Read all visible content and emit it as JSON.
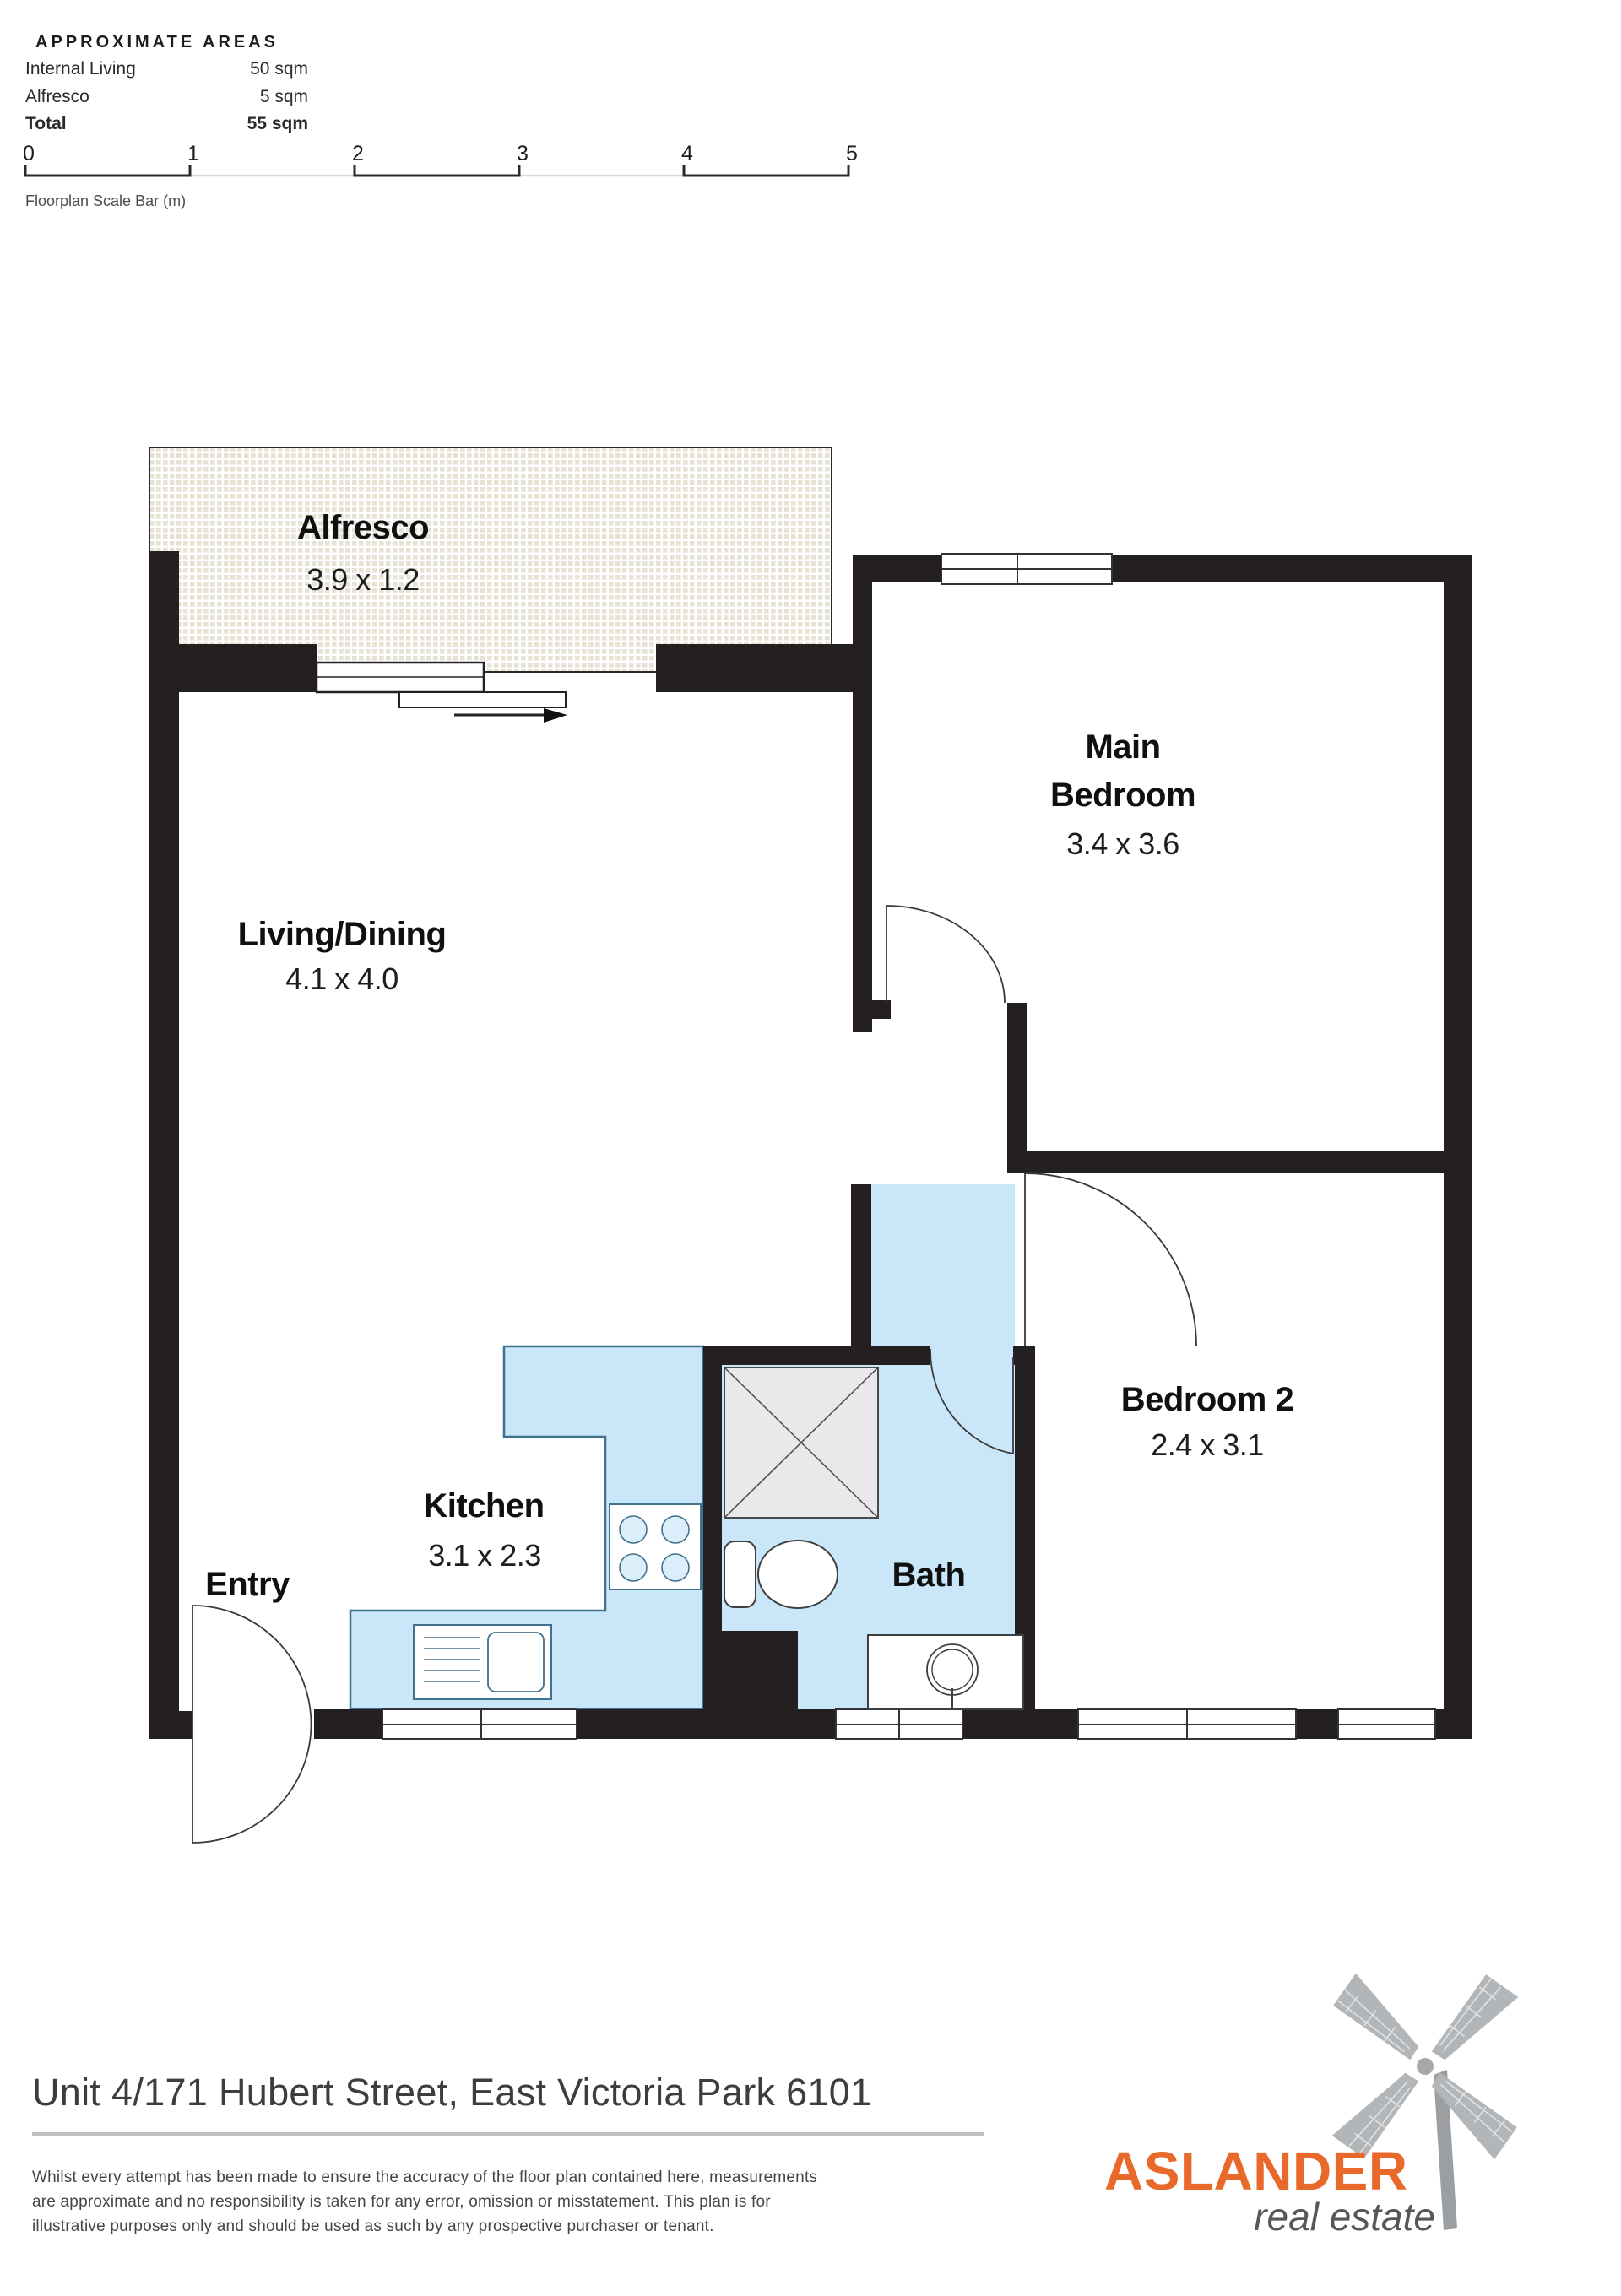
{
  "areas": {
    "title": "APPROXIMATE AREAS",
    "rows": [
      {
        "label": "Internal Living",
        "value": "50 sqm"
      },
      {
        "label": "Alfresco",
        "value": "5 sqm"
      },
      {
        "label": "Total",
        "value": "55 sqm"
      }
    ]
  },
  "scale_bar": {
    "ticks": [
      "0",
      "1",
      "2",
      "3",
      "4",
      "5"
    ],
    "caption": "Floorplan Scale Bar (m)"
  },
  "rooms": {
    "alfresco": {
      "name": "Alfresco",
      "dims": "3.9 x 1.2"
    },
    "living": {
      "name": "Living/Dining",
      "dims": "4.1 x 4.0"
    },
    "main_bedroom": {
      "name_line1": "Main",
      "name_line2": "Bedroom",
      "dims": "3.4 x 3.6"
    },
    "kitchen": {
      "name": "Kitchen",
      "dims": "3.1 x 2.3"
    },
    "bath": {
      "name": "Bath"
    },
    "bedroom2": {
      "name": "Bedroom 2",
      "dims": "2.4 x 3.1"
    },
    "entry": {
      "name": "Entry"
    }
  },
  "footer": {
    "address": "Unit 4/171 Hubert Street, East Victoria Park 6101",
    "disclaimer_lines": [
      "Whilst every attempt has been made to ensure the accuracy of the floor plan contained here, measurements",
      "are approximate and no responsibility is taken for any error, omission or misstatement. This plan is for",
      "illustrative purposes only and should be used as such by any prospective purchaser or tenant."
    ]
  },
  "brand": {
    "name": "ASLANDER",
    "tagline": "real estate"
  },
  "colors": {
    "wall": "#241f20",
    "wet_area": "#c9e7f8",
    "wet_stroke": "#41718c",
    "hatch": "#e6e3d5",
    "fixture_line": "#3f3f3f",
    "shower_fill": "#e9e9ec",
    "accent": "#e8692a",
    "logo_gray": "#b3b6b8",
    "pole_gray": "#9b9fa2"
  }
}
